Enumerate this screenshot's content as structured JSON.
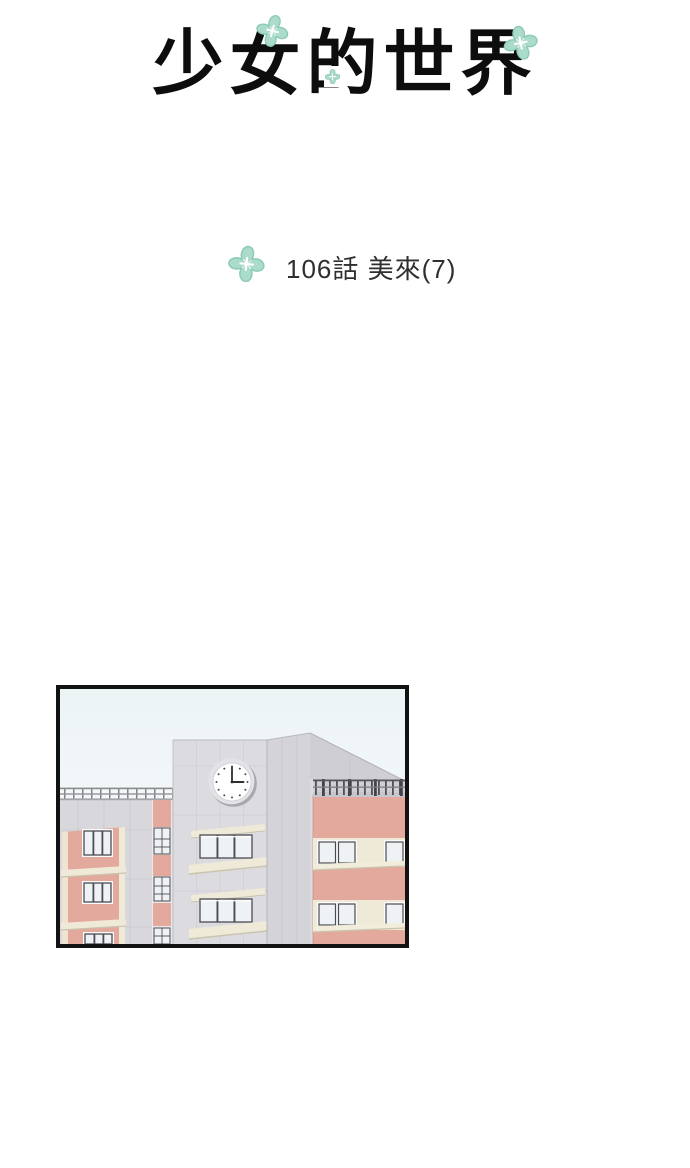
{
  "header": {
    "title": "少女的世界"
  },
  "chapter": {
    "label": "106話 美來(7)"
  },
  "colors": {
    "mint": "#abdcc9",
    "mint_outline": "#8cc9b6",
    "salmon": "#e3a99d",
    "cream": "#efead8",
    "wall_gray": "#d8d7db",
    "tower_front": "#dcdbdf",
    "tower_side": "#d4d3d8",
    "parapet": "#cfced4",
    "sky_top": "#edf4f6",
    "sky_bottom": "#f9fbfb",
    "window_glass": "#eef2f5",
    "frame_dark": "#4c4c52",
    "panel_border": "#121212",
    "text_black": "#0d0d0d",
    "text_gray": "#2f2f2f"
  },
  "illustration": {
    "name": "school-buildings-with-clock-tower",
    "clock_time": "3:00"
  }
}
